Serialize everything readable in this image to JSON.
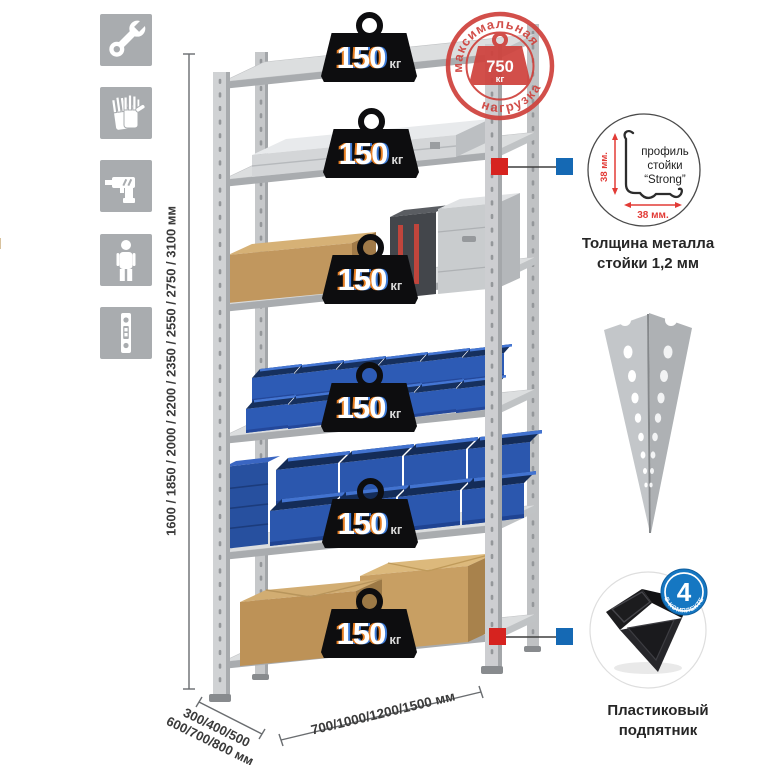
{
  "colors": {
    "accent_red": "#cf423d",
    "marker_red": "#d6231f",
    "marker_blue": "#1569b4",
    "badge_black": "#0d0d0f",
    "bin_blue": "#2d5bb5",
    "icon_bg": "#a9acaf"
  },
  "sidebar_icons": [
    {
      "name": "wrench-icon"
    },
    {
      "name": "gloves-icon"
    },
    {
      "name": "drill-icon"
    },
    {
      "name": "person-icon"
    },
    {
      "name": "perforated-post-icon"
    }
  ],
  "height_dimension": {
    "label": "1600 / 1850 / 2000 / 2200 / 2350 / 2550 / 2750 / 3100 мм"
  },
  "depth_dimension": {
    "line1": "300/400/500",
    "line2": "600/700/800 мм"
  },
  "width_dimension": {
    "label": "700/1000/1200/1500 мм"
  },
  "shelf_badges": [
    {
      "value": "150",
      "unit": "кг"
    },
    {
      "value": "150",
      "unit": "кг"
    },
    {
      "value": "150",
      "unit": "кг"
    },
    {
      "value": "150",
      "unit": "кг"
    },
    {
      "value": "150",
      "unit": "кг"
    },
    {
      "value": "150",
      "unit": "кг"
    }
  ],
  "max_load_stamp": {
    "arc_top": "максимальная",
    "arc_bottom": "нагрузка",
    "value": "750",
    "unit": "кг"
  },
  "profile_detail": {
    "text_line1": "профиль",
    "text_line2": "стойки",
    "text_line3": "“Strong”",
    "vertical_dim": "38 мм.",
    "horizontal_dim": "38 мм.",
    "caption_line1": "Толщина металла",
    "caption_line2": "стойки 1,2 мм"
  },
  "foot_detail": {
    "badge_value": "4",
    "badge_arc": "в комплекте",
    "caption_line1": "Пластиковый",
    "caption_line2": "подпятник"
  }
}
